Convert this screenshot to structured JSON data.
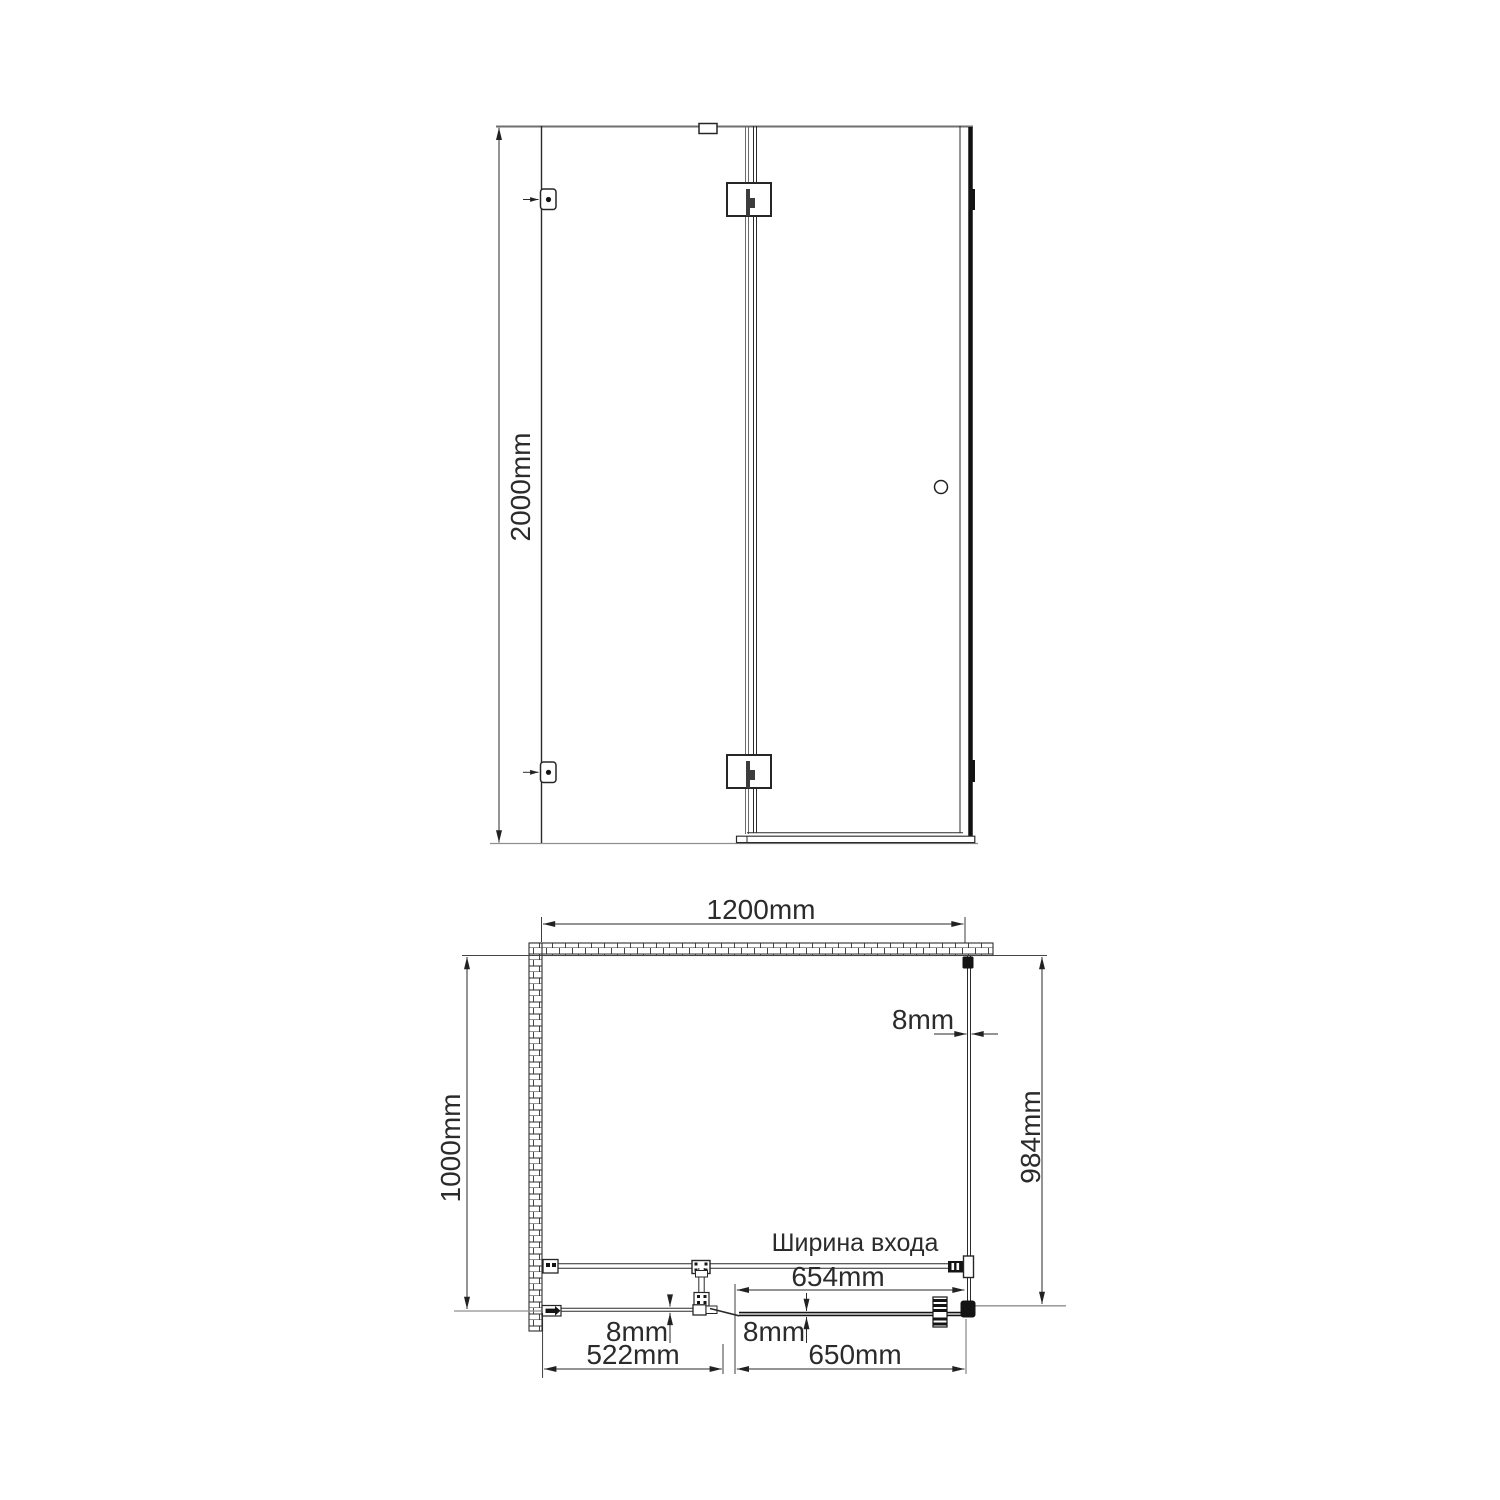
{
  "page": {
    "background": "#ffffff",
    "description": "Technical dimension drawing of a corner shower enclosure: front elevation (top) and plan view (bottom)"
  },
  "colors": {
    "line": "#2a2a2a",
    "gray_line": "#8f8f8f",
    "text": "#2b2b2b",
    "fitting_black": "#141414",
    "background": "#ffffff"
  },
  "front_view": {
    "height_label": "2000mm"
  },
  "plan_view": {
    "width_label": "1200mm",
    "depth_label": "1000mm",
    "side_glass_thickness_label": "8mm",
    "side_panel_depth_label": "984mm",
    "entrance_caption": "Ширина входа",
    "entrance_width_label": "654mm",
    "fixed_glass_thickness_label": "8mm",
    "door_glass_thickness_label": "8mm",
    "fixed_panel_width_label": "522mm",
    "door_width_label": "650mm"
  }
}
